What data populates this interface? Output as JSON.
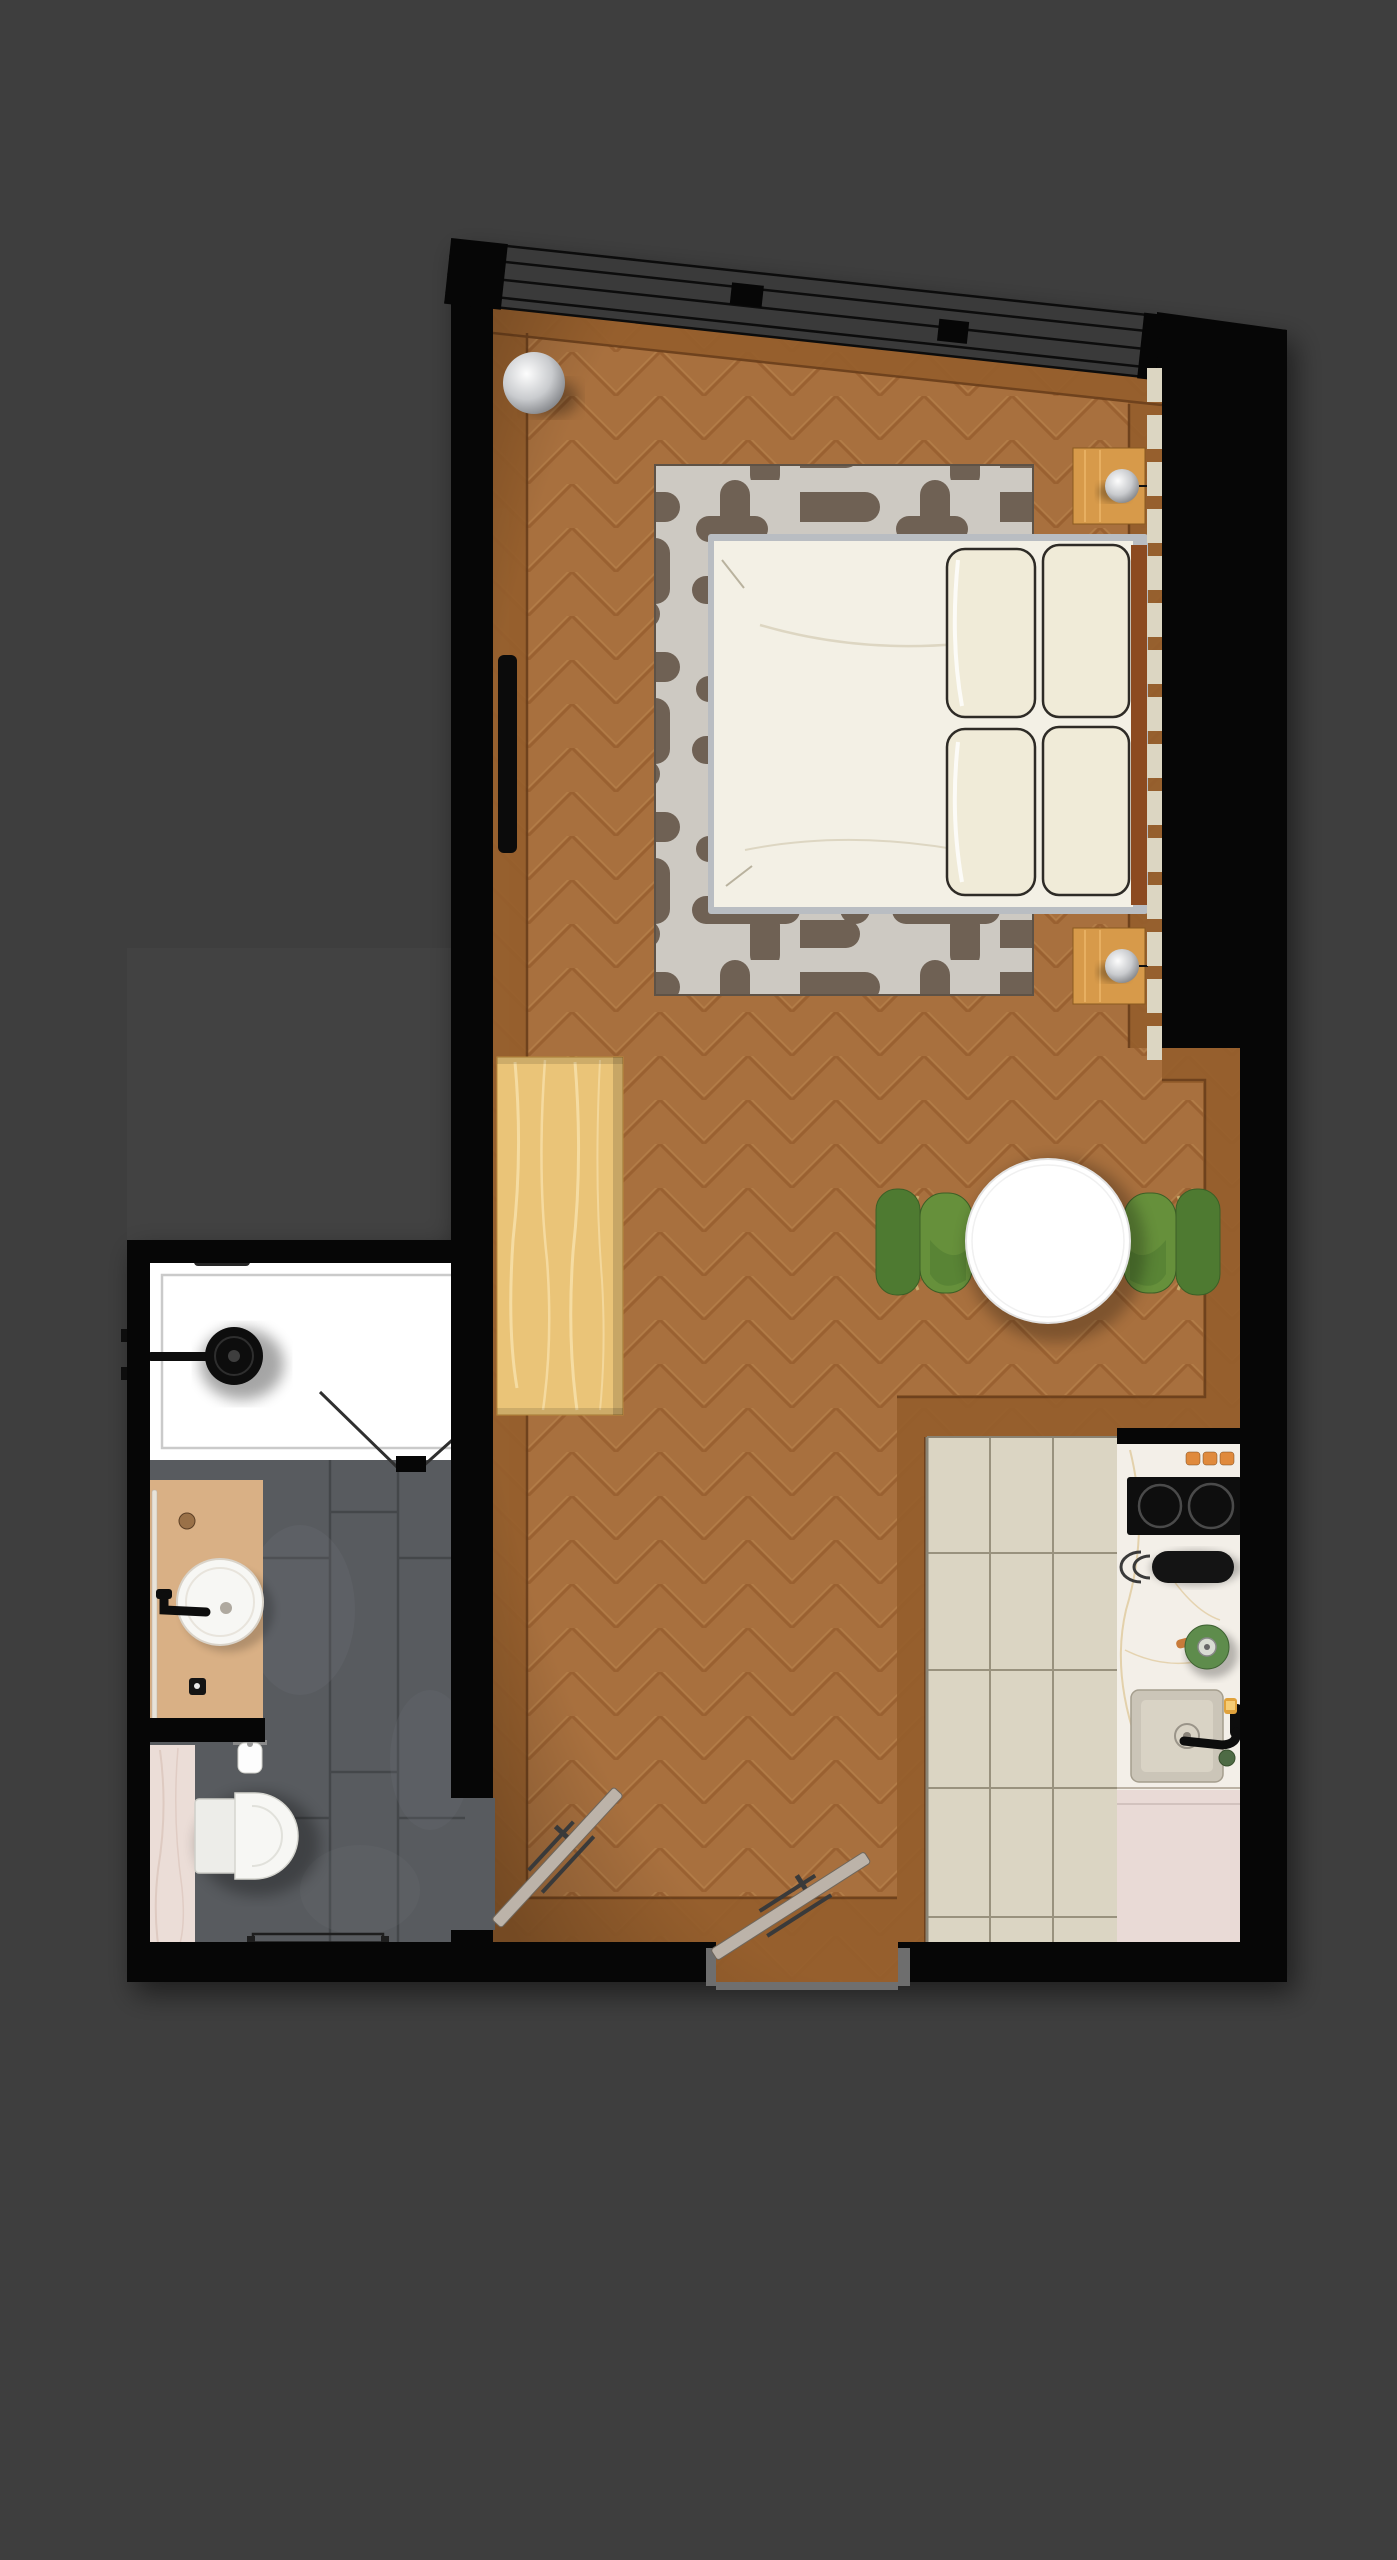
{
  "scene": {
    "kind": "floor-plan-render",
    "description": "Top-down 3D render of a studio apartment floor plan",
    "rooms": [
      {
        "id": "living-bedroom",
        "label": "Living / Bedroom",
        "objects": [
          "window-band",
          "pendant-lamp",
          "tv-panel",
          "wardrobe",
          "rug",
          "double-bed",
          "pillows",
          "headboard",
          "nightstand-upper",
          "nightstand-lower",
          "table-lamp-upper",
          "table-lamp-lower",
          "wall-radiator",
          "dining-table",
          "dining-chair-left",
          "dining-chair-right",
          "entry-door"
        ]
      },
      {
        "id": "kitchen",
        "label": "Kitchen",
        "objects": [
          "tile-floor",
          "worktop",
          "hob",
          "hob-knobs",
          "pan",
          "kettle",
          "sink",
          "tap",
          "soap",
          "plant-pot",
          "lower-worktop"
        ]
      },
      {
        "id": "bathroom",
        "label": "Bathroom",
        "objects": [
          "shower-tray",
          "shower-head",
          "shower-rail",
          "shower-valves",
          "glass-screen",
          "vanity-counter",
          "basin",
          "basin-tap",
          "soap-pump",
          "toilet",
          "toilet-paper",
          "marble-panel",
          "towel-radiator",
          "bathroom-door"
        ]
      }
    ]
  },
  "colors": {
    "background": "#3E3E3E",
    "background_pocket": "#454545",
    "wall": "#060606",
    "window_band": "#3A3A3A",
    "window_line": "#0C0C0C",
    "wood_base": "#A8703E",
    "wood_band": "#955E2C",
    "wood_band_line": "#6B3F1B",
    "rug_bg": "#CDC9C2",
    "rug_blob": "#6F6154",
    "bed_metal": "#B9BDC2",
    "bed_duvet": "#F3F0E5",
    "pillow": "#F0EBD8",
    "pillow_line": "#2E2B26",
    "headboard": "#8C4A20",
    "nightstand": "#D79A4A",
    "wardrobe": "#EAC478",
    "wardrobe_streak": "#F7E0A9",
    "tv_black": "#0B0B0B",
    "radiator_seg": "#DCD6C2",
    "table_white": "#FFFFFF",
    "chair_green_dark": "#4E7A31",
    "chair_green": "#66903B",
    "brass": "#C8A86B",
    "tile_kitchen": "#DBD5C3",
    "grout_kitchen": "#99927E",
    "counter": "#F3EFE8",
    "counter_vein": "#D8BC82",
    "counter_pink": "#E9DAD6",
    "cooktop": "#0E0E0E",
    "burner_ring": "#4A4A4A",
    "knob_orange": "#E08A3C",
    "kettle_green": "#5E8C4C",
    "bath_tile": "#585B5F",
    "bath_joint": "#44474A",
    "shower_white": "#FFFFFF",
    "shower_line": "#CACACA",
    "vanity_tan": "#D9B085",
    "fixture_black": "#0D0D0D",
    "toilet_panel": "#EBDDD7",
    "porcelain": "#F7F7F4",
    "door_leaf": "#BCB3A9",
    "door_edge": "#6E665C",
    "jamb_grey": "#6E6E6E",
    "bronze": "#9A7148"
  }
}
